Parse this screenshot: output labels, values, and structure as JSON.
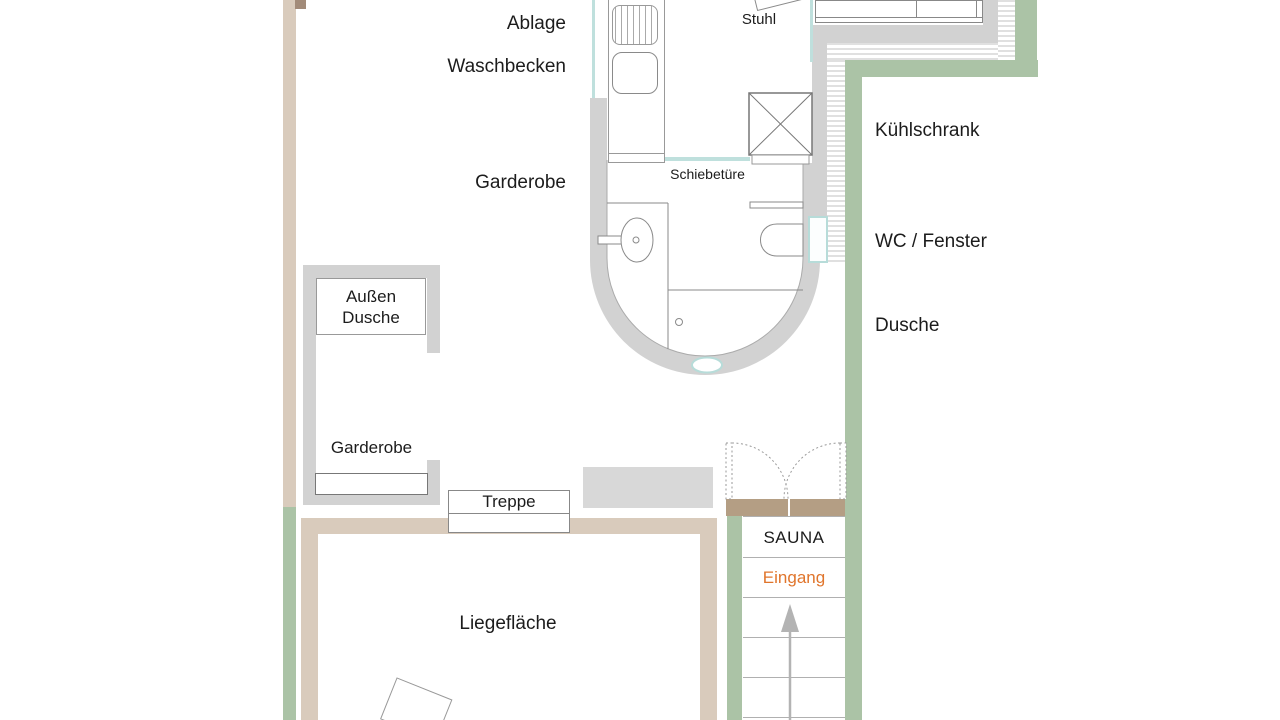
{
  "labels": {
    "ablage": "Ablage",
    "waschbecken": "Waschbecken",
    "garderobe_bad": "Garderobe",
    "stuhl": "Stuhl",
    "schiebetuere": "Schiebetüre",
    "kuehlschrank": "Kühlschrank",
    "wc_fenster": "WC / Fenster",
    "dusche": "Dusche",
    "aussen_dusche_line1": "Außen",
    "aussen_dusche_line2": "Dusche",
    "garderobe_aussen": "Garderobe",
    "treppe": "Treppe",
    "liegeflaeche": "Liegefläche",
    "sauna": "SAUNA",
    "eingang": "Eingang"
  },
  "colors": {
    "wall_gray": "#d2d2d2",
    "wall_tan": "#d9cbbc",
    "wall_green": "#abc3a6",
    "threshold_tan": "#b49e84",
    "glass_teal": "#bfe0dd",
    "eingang_orange": "#e0752c",
    "text": "#1c1c1c"
  }
}
